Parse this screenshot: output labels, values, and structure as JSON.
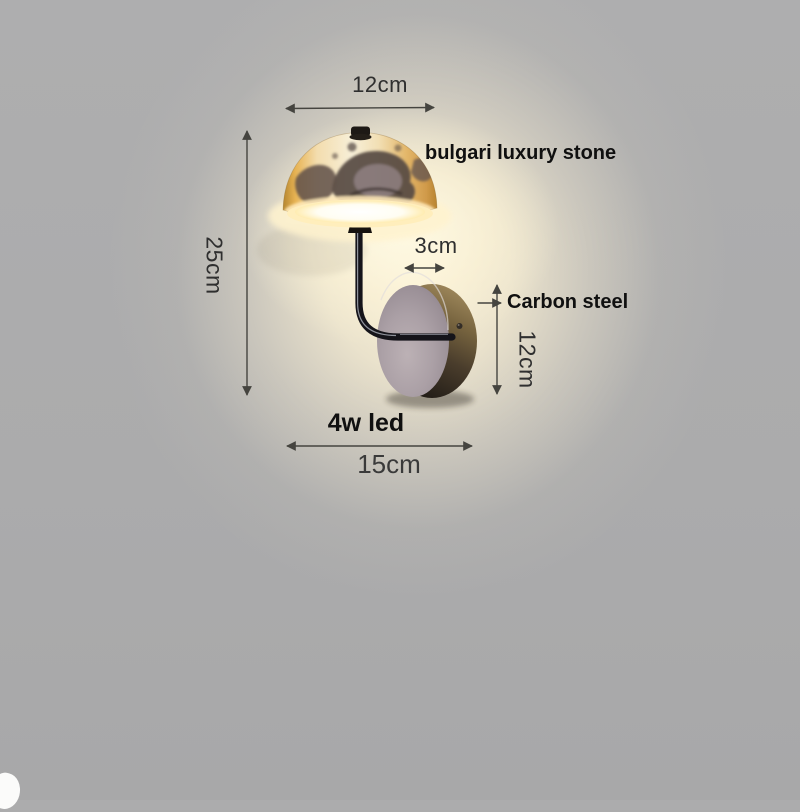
{
  "product": {
    "shade_material_label": "bulgari luxury stone",
    "mount_material_label": "Carbon steel",
    "power_label": "4w led"
  },
  "dimensions": {
    "shade_width": "12cm",
    "overall_height": "25cm",
    "arm_offset": "3cm",
    "mount_height": "12cm",
    "overall_width": "15cm"
  },
  "colors": {
    "wall": "#acacad",
    "glow_warm": "#fdf3da",
    "shade_gold": "#e7b353",
    "shade_cream": "#f7efd8",
    "stone_dark": "#564943",
    "metal_dark": "#15141a",
    "mount_rim_bronze": "#77643f",
    "mount_face_mauve": "#aba0a6",
    "annotation_line": "#45443f",
    "annotation_text": "#2f2f2f"
  },
  "icons": {
    "dimension_arrows": "double-headed measurement arrows",
    "pointer_arrow": "right-pointing label arrow"
  }
}
